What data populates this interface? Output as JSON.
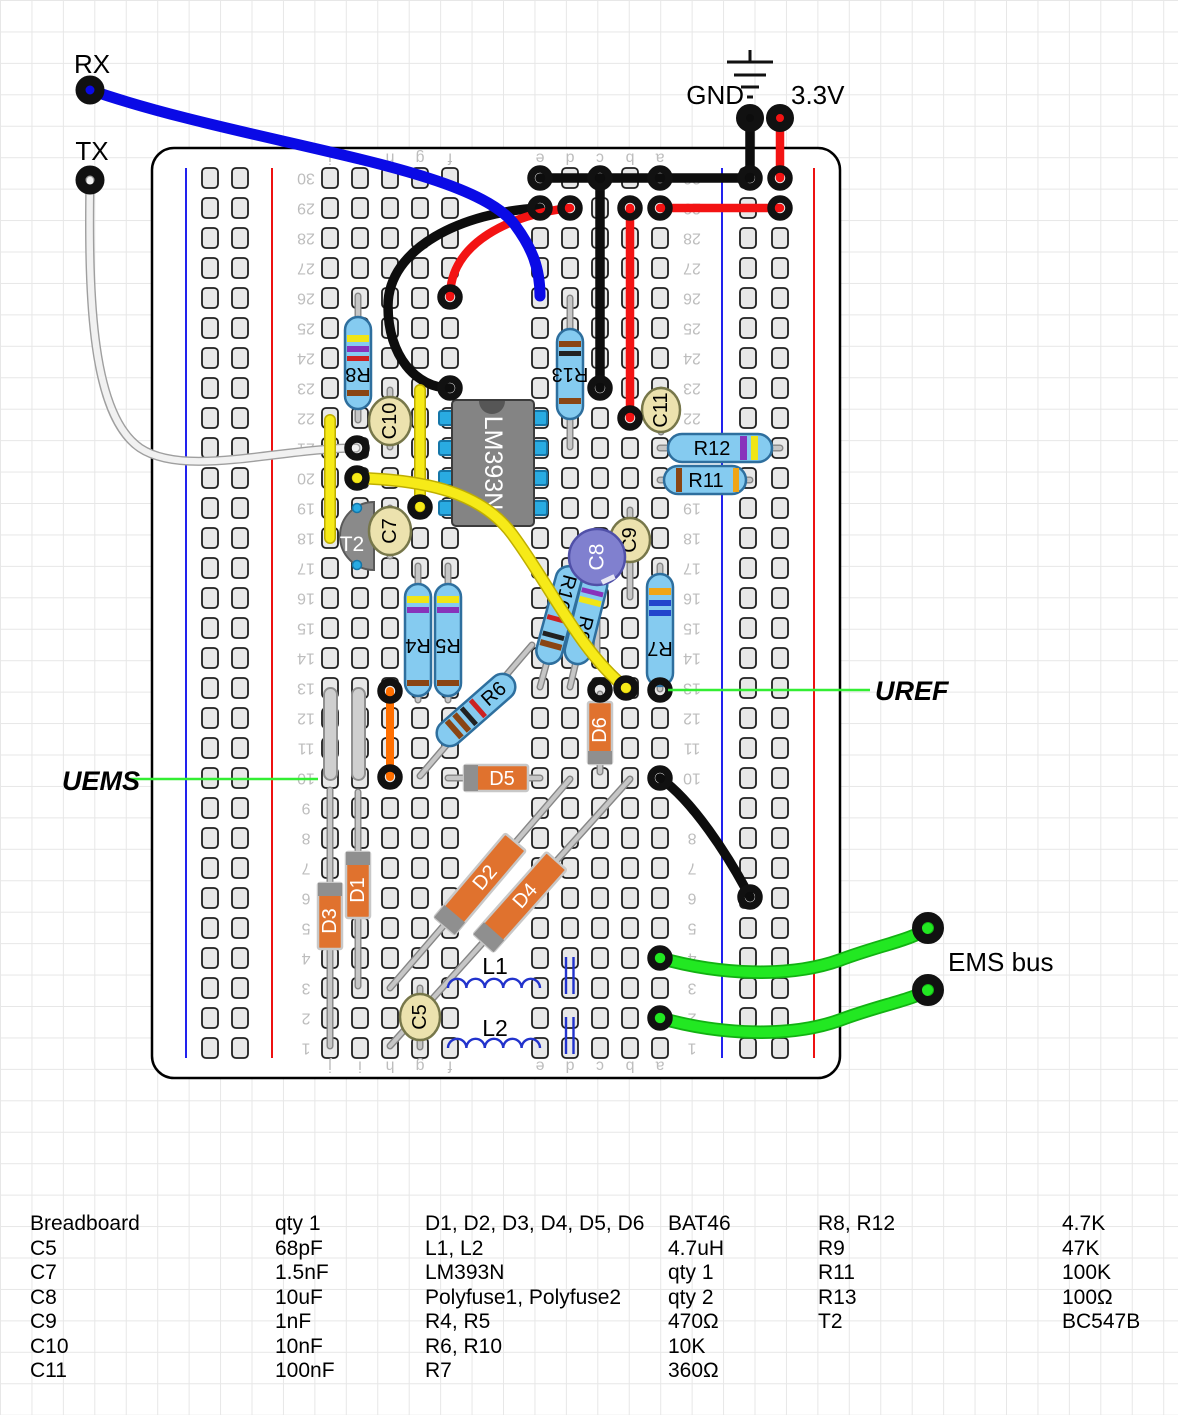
{
  "labels": {
    "rx": "RX",
    "tx": "TX",
    "gnd": "GND",
    "v33": "3.3V",
    "uref": "UREF",
    "uems": "UEMS",
    "ems_bus": "EMS bus"
  },
  "components": {
    "ic": "LM393N",
    "t2": "T2",
    "r4": "R4",
    "r5": "R5",
    "r6": "R6",
    "r7": "R7",
    "r8": "R8",
    "r9": "R9",
    "r10": "R10",
    "r11": "R11",
    "r12": "R12",
    "r13": "R13",
    "c5": "C5",
    "c7": "C7",
    "c8": "C8",
    "c9": "C9",
    "c10": "C10",
    "c11": "C11",
    "d1": "D1",
    "d2": "D2",
    "d3": "D3",
    "d4": "D4",
    "d5": "D5",
    "d6": "D6",
    "l1": "L1",
    "l2": "L2"
  },
  "breadboard": {
    "column_letters": [
      "j",
      "i",
      "h",
      "g",
      "f",
      "e",
      "d",
      "c",
      "b",
      "a"
    ],
    "row_numbers": [
      "1",
      "2",
      "3",
      "4",
      "5",
      "6",
      "7",
      "8",
      "9",
      "10",
      "11",
      "12",
      "13",
      "14",
      "15",
      "16",
      "17",
      "18",
      "19",
      "20",
      "21",
      "22",
      "23",
      "24",
      "25",
      "26",
      "27",
      "28",
      "29",
      "30"
    ]
  },
  "parts_list": {
    "group1": [
      [
        "Breadboard",
        "qty 1"
      ],
      [
        "C5",
        "68pF"
      ],
      [
        "C7",
        "1.5nF"
      ],
      [
        "C8",
        "10uF"
      ],
      [
        "C9",
        "1nF"
      ],
      [
        "C10",
        "10nF"
      ],
      [
        "C11",
        "100nF"
      ]
    ],
    "group2": [
      [
        "D1, D2, D3, D4, D5, D6",
        "BAT46"
      ],
      [
        "L1, L2",
        "4.7uH"
      ],
      [
        "LM393N",
        "qty 1"
      ],
      [
        "Polyfuse1, Polyfuse2",
        "qty 2"
      ],
      [
        "R4, R5",
        "470Ω"
      ],
      [
        "R6, R10",
        "10K"
      ],
      [
        "R7",
        "360Ω"
      ]
    ],
    "group3": [
      [
        "R8, R12",
        "4.7K"
      ],
      [
        "R9",
        "47K"
      ],
      [
        "R11",
        "100K"
      ],
      [
        "R13",
        "100Ω"
      ],
      [
        "T2",
        "BC547B"
      ]
    ]
  },
  "colors": {
    "wire_black": "#0d0d0d",
    "wire_red": "#f31313",
    "wire_blue": "#0a0ae6",
    "wire_yellow": "#f6ea18",
    "wire_green": "#22e822",
    "wire_white": "#f1f1f1",
    "wire_orange": "#ff6f00",
    "resistor_body": "#85cbf0",
    "diode_body": "#e0722e",
    "cap_body": "#ece2ae",
    "cap_electrolytic": "#8080cf",
    "ic_body": "#848484",
    "pin_blue": "#29abe2",
    "callout_green": "#33ee33"
  }
}
